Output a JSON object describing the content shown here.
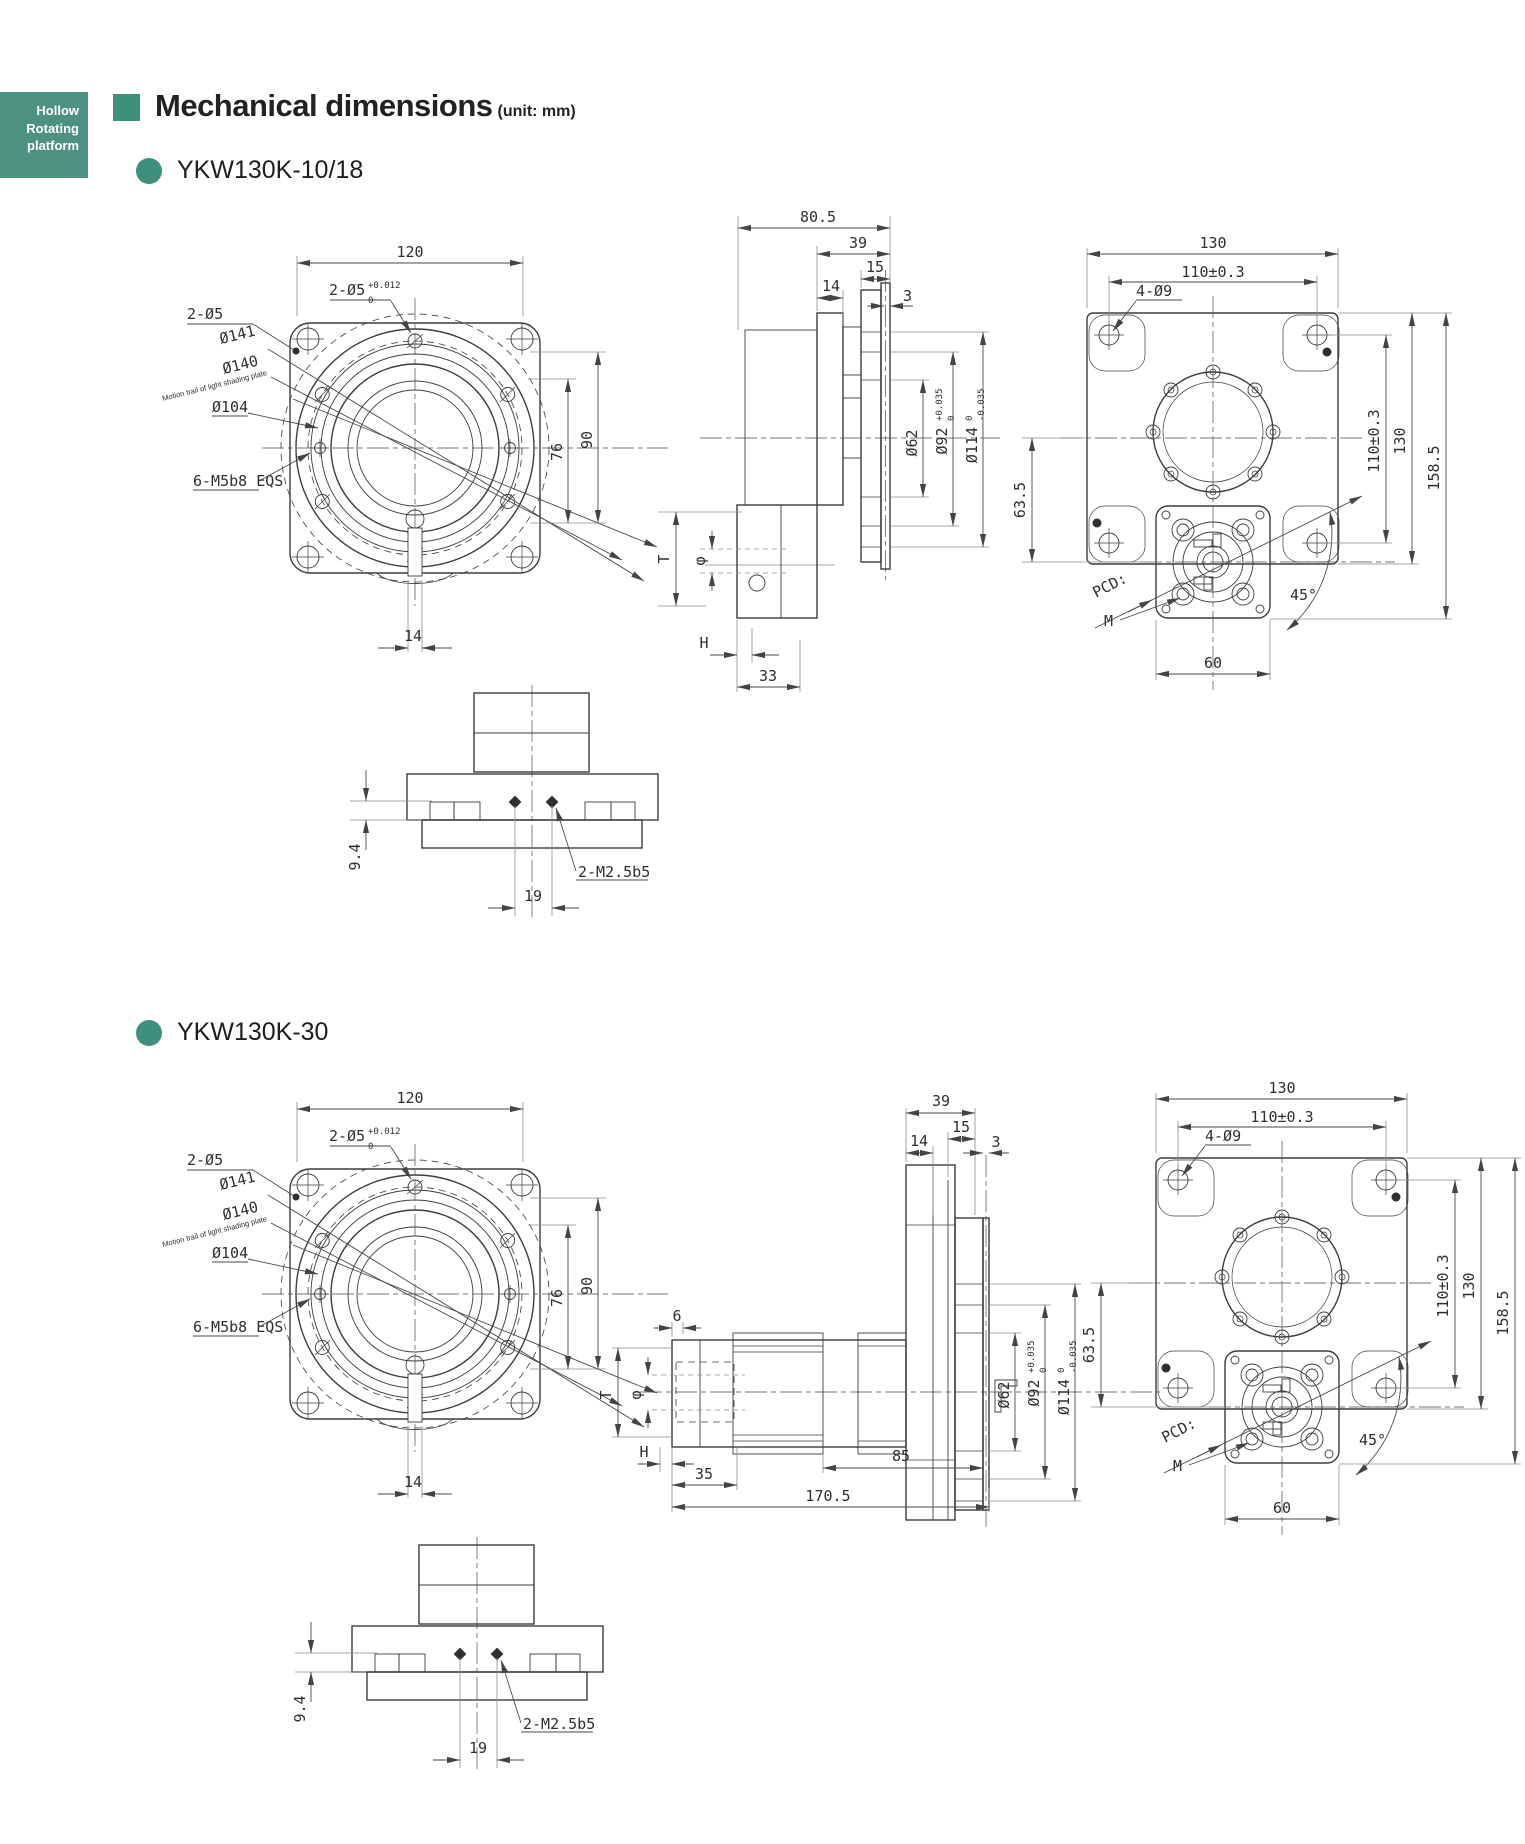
{
  "colors": {
    "tab_bg": "#4E9181",
    "accent": "#3E8F7B"
  },
  "tab": {
    "line1": "Hollow",
    "line2": "Rotating",
    "line3": "platform"
  },
  "header": {
    "title": "Mechanical dimensions",
    "unit": "(unit: mm)"
  },
  "section1": {
    "title": "YKW130K-10/18",
    "front": {
      "dim_width": "120",
      "pin_pair": "2-Ø5",
      "pin_tol_up": "+0.012",
      "pin_tol_dn": "0",
      "pin_pair2": "2-Ø5",
      "dia_141": "Ø141",
      "dia_140": "Ø140",
      "motion_note": "Motion trail of light shading plate",
      "dia_104": "Ø104",
      "screw_note": "6-M5b8 EQS",
      "dim_90": "90",
      "dim_76": "76",
      "dim_key": "14"
    },
    "side": {
      "dim_depth": "80.5",
      "dim_39": "39",
      "dim_14": "14",
      "dim_15": "15",
      "dim_3": "3",
      "dia_62": "Ø62",
      "dia_92": "Ø92",
      "dia_92_up": "+0.035",
      "dia_92_dn": "0",
      "dia_114": "Ø114",
      "dia_114_up": "0",
      "dia_114_dn": "-0.035",
      "dim_T": "T",
      "dim_phi": "φ",
      "dim_H": "H",
      "dim_33": "33"
    },
    "back": {
      "dim_130_top": "130",
      "dim_110_top": "110±0.3",
      "hole_note": "4-Ø9",
      "dim_63_5": "63.5",
      "dim_110_right": "110±0.3",
      "dim_130_right": "130",
      "dim_158_5": "158.5",
      "pcd_label": "PCD:",
      "m_label": "M",
      "angle_45": "45°",
      "dim_60": "60"
    },
    "bottom": {
      "dim_9_4": "9.4",
      "dim_19": "19",
      "thread_note": "2-M2.5b5"
    }
  },
  "section2": {
    "title": "YKW130K-30",
    "front": {
      "dim_width": "120",
      "pin_pair": "2-Ø5",
      "pin_tol_up": "+0.012",
      "pin_tol_dn": "0",
      "pin_pair2": "2-Ø5",
      "dia_141": "Ø141",
      "dia_140": "Ø140",
      "motion_note": "Motion trail of light shading plate",
      "dia_104": "Ø104",
      "screw_note": "6-M5b8 EQS",
      "dim_90": "90",
      "dim_76": "76",
      "dim_key": "14"
    },
    "side": {
      "dim_39": "39",
      "dim_14": "14",
      "dim_15": "15",
      "dim_3": "3",
      "dim_6": "6",
      "dia_62": "Ø62",
      "dia_92": "Ø92",
      "dia_92_up": "+0.035",
      "dia_92_dn": "0",
      "dia_114": "Ø114",
      "dia_114_up": "0",
      "dia_114_dn": "-0.035",
      "dim_T": "T",
      "dim_phi": "φ",
      "dim_H": "H",
      "dim_35": "35",
      "dim_85": "85",
      "dim_170_5": "170.5"
    },
    "back": {
      "dim_130_top": "130",
      "dim_110_top": "110±0.3",
      "hole_note": "4-Ø9",
      "dim_63_5": "63.5",
      "dim_110_right": "110±0.3",
      "dim_130_right": "130",
      "dim_158_5": "158.5",
      "pcd_label": "PCD:",
      "m_label": "M",
      "angle_45": "45°",
      "dim_60": "60"
    },
    "bottom": {
      "dim_9_4": "9.4",
      "dim_19": "19",
      "thread_note": "2-M2.5b5"
    }
  }
}
